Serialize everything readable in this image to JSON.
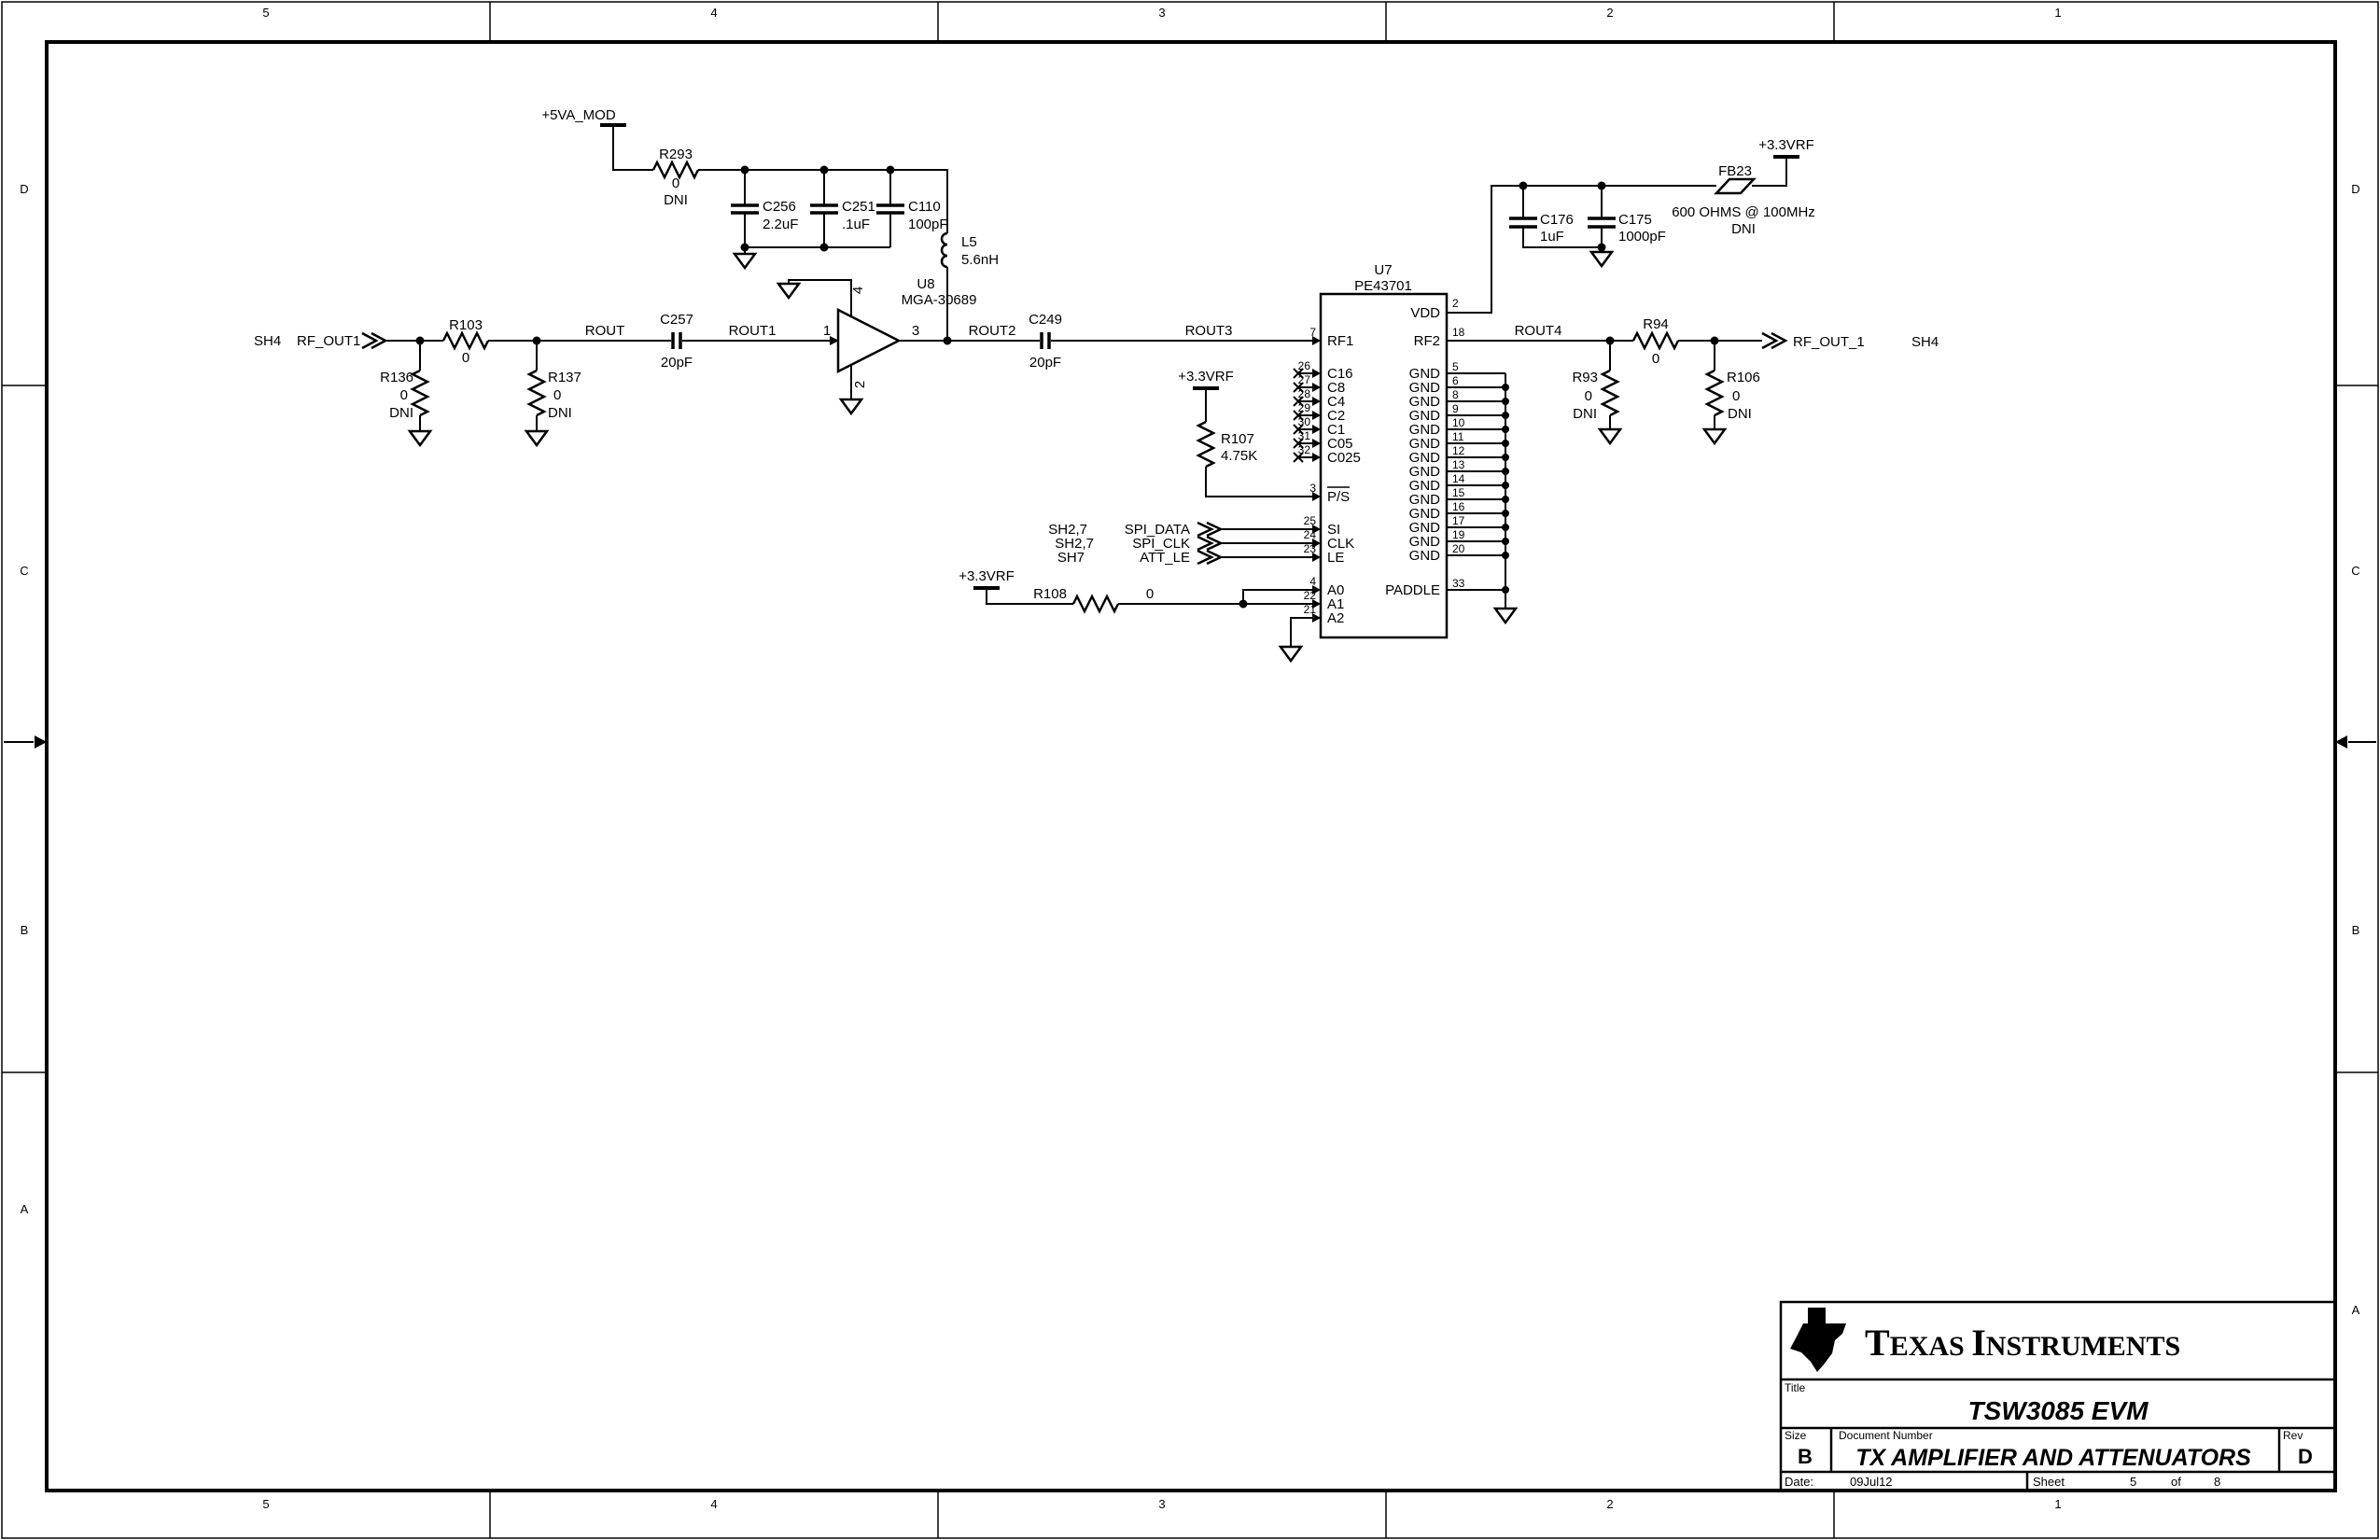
{
  "border": {
    "zones_h": [
      "5",
      "4",
      "3",
      "2",
      "1"
    ],
    "zones_v": [
      "D",
      "C",
      "B",
      "A"
    ]
  },
  "title_block": {
    "brand_t": "T",
    "brand_exas": "EXAS ",
    "brand_i": "I",
    "brand_nstruments": "NSTRUMENTS",
    "title_label": "Title",
    "title": "TSW3085 EVM",
    "size_label": "Size",
    "size": "B",
    "doc_label": "Document Number",
    "doc": "TX AMPLIFIER AND ATTENUATORS",
    "rev_label": "Rev",
    "rev": "D",
    "date_label": "Date:",
    "date": "09Jul12",
    "sheet_label": "Sheet",
    "sheet": "5",
    "of_label": "of",
    "total": "8",
    "logo_ti": "ti"
  },
  "power": {
    "p5va": "+5VA_MOD",
    "p33_ps": "+3.3VRF",
    "p33_addr": "+3.3VRF",
    "p33_fb": "+3.3VRF"
  },
  "nets": {
    "rout": "ROUT",
    "rout1": "ROUT1",
    "rout2": "ROUT2",
    "rout3": "ROUT3",
    "rout4": "ROUT4"
  },
  "connectors": {
    "in": {
      "sheet": "SH4",
      "name": "RF_OUT1"
    },
    "out": {
      "name": "RF_OUT_1",
      "sheet": "SH4"
    },
    "spi": [
      {
        "sheet": "SH2,7",
        "name": "SPI_DATA"
      },
      {
        "sheet": "SH2,7",
        "name": "SPI_CLK"
      },
      {
        "sheet": "SH7",
        "name": "ATT_LE"
      }
    ]
  },
  "components": {
    "r293": {
      "ref": "R293",
      "value": "0",
      "note": "DNI"
    },
    "c256": {
      "ref": "C256",
      "value": "2.2uF"
    },
    "c251": {
      "ref": "C251",
      "value": ".1uF"
    },
    "c110": {
      "ref": "C110",
      "value": "100pF"
    },
    "l5": {
      "ref": "L5",
      "value": "5.6nH"
    },
    "r103": {
      "ref": "R103",
      "value": "0"
    },
    "r136": {
      "ref": "R136",
      "value": "0",
      "note": "DNI"
    },
    "r137": {
      "ref": "R137",
      "value": "0",
      "note": "DNI"
    },
    "c257": {
      "ref": "C257",
      "value": "20pF"
    },
    "c249": {
      "ref": "C249",
      "value": "20pF"
    },
    "r107": {
      "ref": "R107",
      "value": "4.75K"
    },
    "r108": {
      "ref": "R108",
      "value": "0"
    },
    "c176": {
      "ref": "C176",
      "value": "1uF"
    },
    "c175": {
      "ref": "C175",
      "value": "1000pF"
    },
    "fb23": {
      "ref": "FB23",
      "value": "600 OHMS @ 100MHz",
      "note": "DNI"
    },
    "r94": {
      "ref": "R94",
      "value": "0"
    },
    "r93": {
      "ref": "R93",
      "value": "0",
      "note": "DNI"
    },
    "r106": {
      "ref": "R106",
      "value": "0",
      "note": "DNI"
    }
  },
  "u8": {
    "ref": "U8",
    "part": "MGA-30689",
    "pin_in": "1",
    "pin_out": "3",
    "pin_top": "4",
    "pin_bot": "2"
  },
  "u7": {
    "ref": "U7",
    "part": "PE43701",
    "left_pins": [
      {
        "num": "7",
        "name": "RF1"
      },
      {
        "num": "26",
        "name": "C16"
      },
      {
        "num": "27",
        "name": "C8"
      },
      {
        "num": "28",
        "name": "C4"
      },
      {
        "num": "29",
        "name": "C2"
      },
      {
        "num": "30",
        "name": "C1"
      },
      {
        "num": "31",
        "name": "C05"
      },
      {
        "num": "32",
        "name": "C025"
      },
      {
        "num": "3",
        "name": "P/S"
      },
      {
        "num": "25",
        "name": "SI"
      },
      {
        "num": "24",
        "name": "CLK"
      },
      {
        "num": "23",
        "name": "LE"
      },
      {
        "num": "4",
        "name": "A0"
      },
      {
        "num": "22",
        "name": "A1"
      },
      {
        "num": "21",
        "name": "A2"
      }
    ],
    "right_pins": [
      {
        "num": "2",
        "name": "VDD"
      },
      {
        "num": "18",
        "name": "RF2"
      },
      {
        "num": "5",
        "name": "GND"
      },
      {
        "num": "6",
        "name": "GND"
      },
      {
        "num": "8",
        "name": "GND"
      },
      {
        "num": "9",
        "name": "GND"
      },
      {
        "num": "10",
        "name": "GND"
      },
      {
        "num": "11",
        "name": "GND"
      },
      {
        "num": "12",
        "name": "GND"
      },
      {
        "num": "13",
        "name": "GND"
      },
      {
        "num": "14",
        "name": "GND"
      },
      {
        "num": "15",
        "name": "GND"
      },
      {
        "num": "16",
        "name": "GND"
      },
      {
        "num": "17",
        "name": "GND"
      },
      {
        "num": "19",
        "name": "GND"
      },
      {
        "num": "20",
        "name": "GND"
      },
      {
        "num": "33",
        "name": "PADDLE"
      }
    ]
  }
}
